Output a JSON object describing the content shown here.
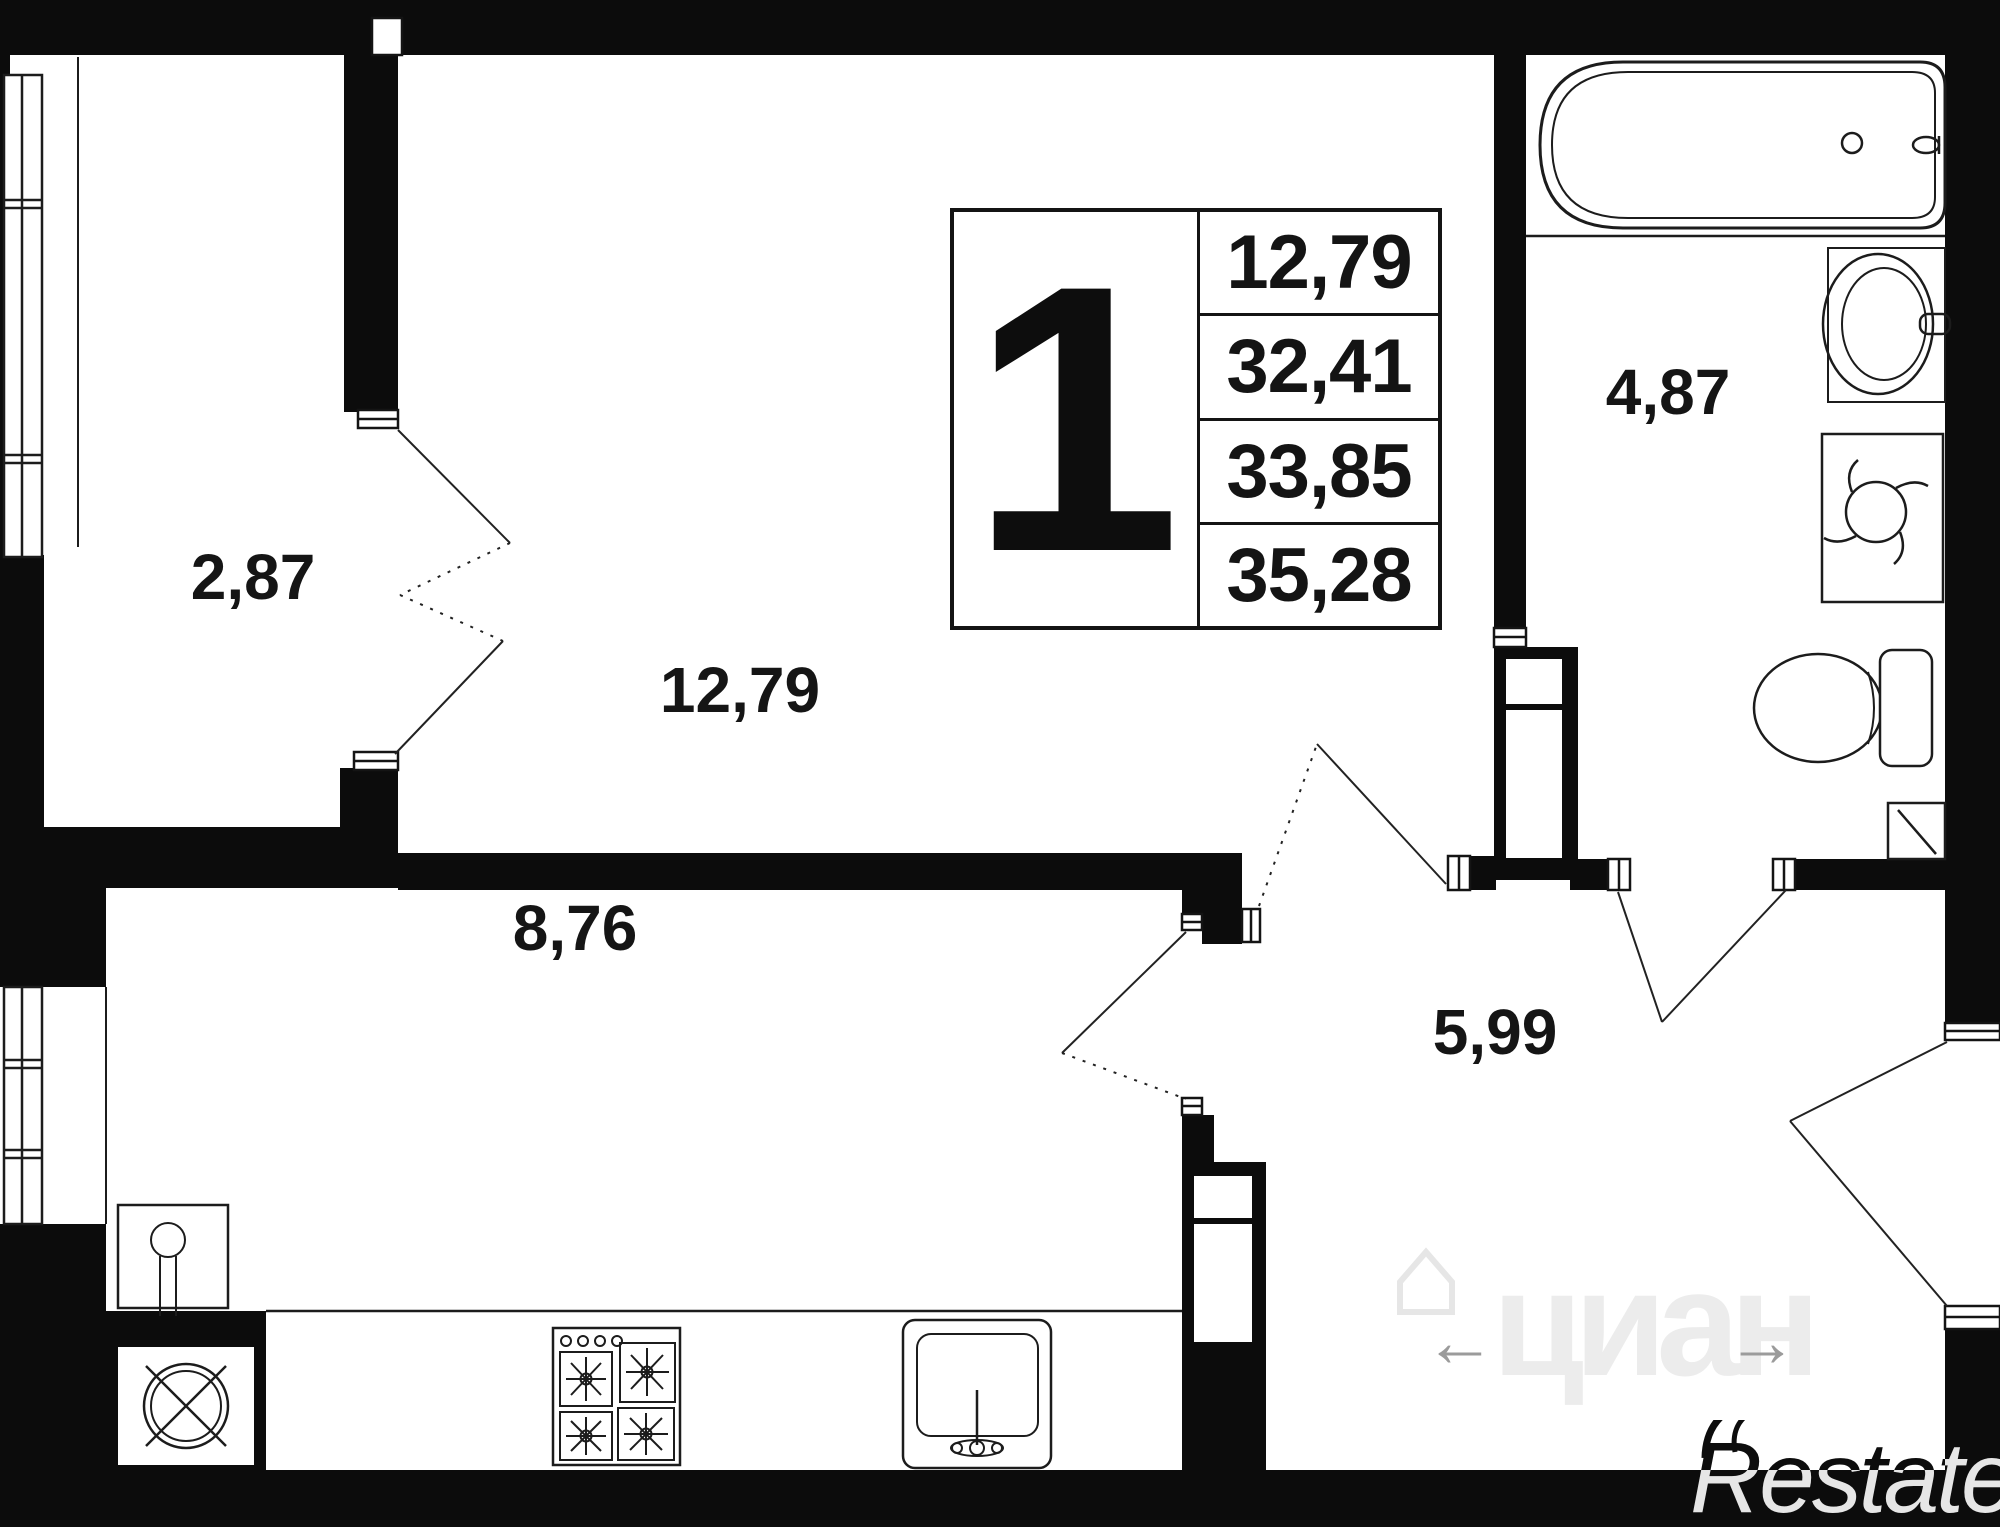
{
  "floorplan": {
    "title": "1-room apartment floor plan",
    "legend": {
      "rooms_count": "1",
      "areas": [
        "12,79",
        "32,41",
        "33,85",
        "35,28"
      ]
    },
    "rooms": [
      {
        "name": "balcony",
        "area": "2,87"
      },
      {
        "name": "living-room",
        "area": "12,79"
      },
      {
        "name": "kitchen",
        "area": "8,76"
      },
      {
        "name": "hallway",
        "area": "5,99"
      },
      {
        "name": "bathroom",
        "area": "4,87"
      }
    ],
    "fixtures": [
      "bathtub-icon",
      "bath-sink-icon",
      "washing-machine-icon",
      "toilet-icon",
      "stove-icon",
      "kitchen-sink-icon",
      "vent-shaft-icon",
      "water-riser-icon",
      "window-icon",
      "door-swing-icon"
    ],
    "colors": {
      "wall": "#0c0c0c",
      "line": "#1c1c1c",
      "watermark_light": "#ececec",
      "watermark_arrow": "#9b9b9b"
    },
    "watermarks": {
      "cian_text": "циан",
      "left_arrow": "←",
      "right_arrow": "→",
      "restate_text": "Restate"
    }
  }
}
